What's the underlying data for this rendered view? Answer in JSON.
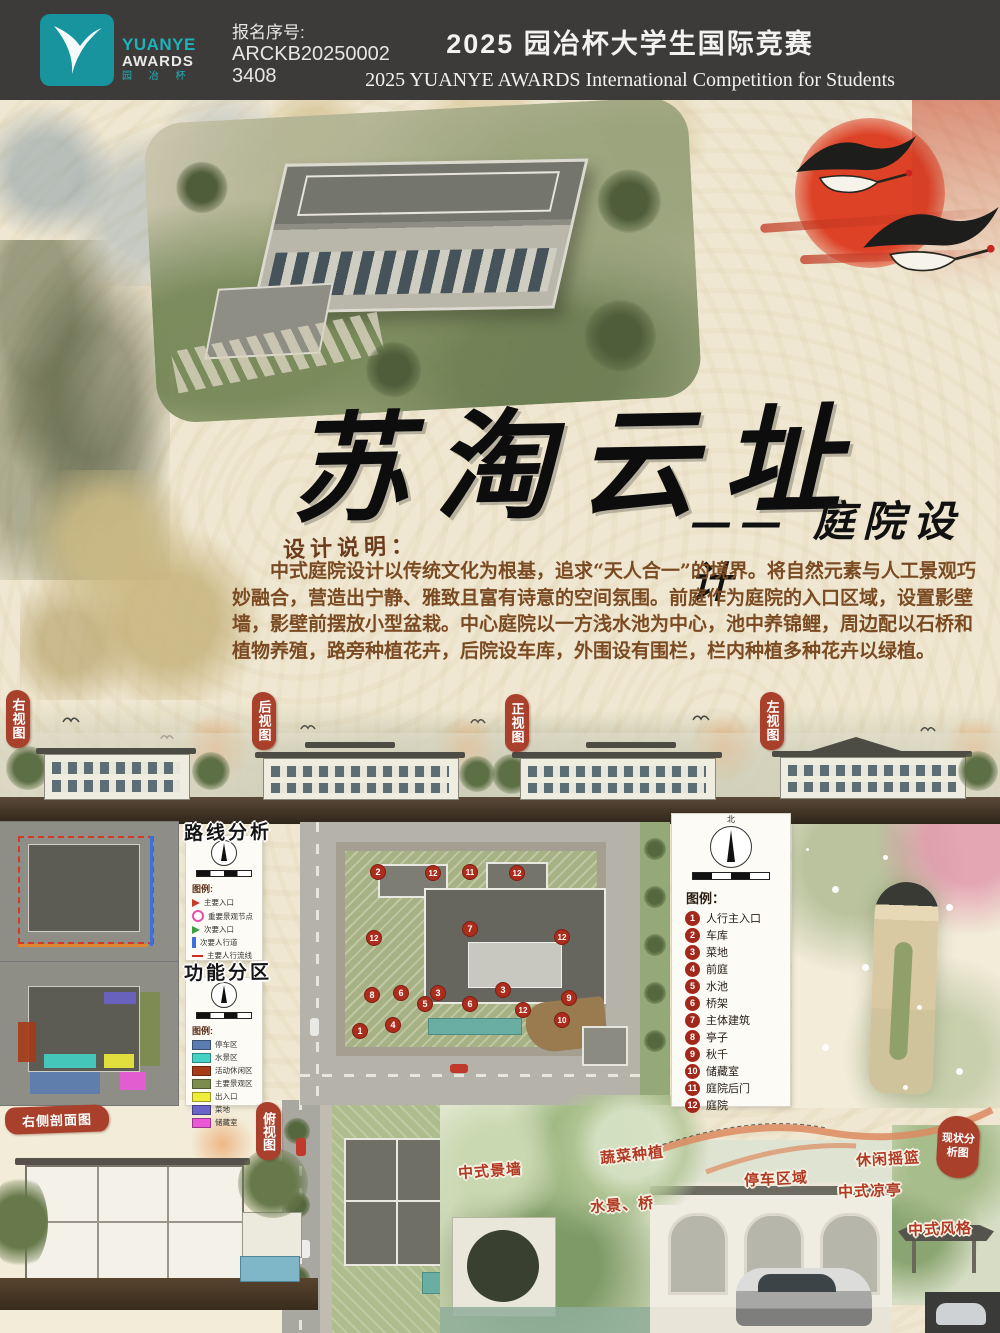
{
  "header": {
    "logo": {
      "yuanye": "YUANYE",
      "awards": "AWARDS",
      "cn": "园 冶 杯"
    },
    "reg_label": "报名序号:",
    "reg_line1": "ARCKB20250002",
    "reg_line2": "3408",
    "title_cn": "2025 园冶杯大学生国际竞赛",
    "title_en": "2025 YUANYE AWARDS International Competition for  Students"
  },
  "hero": {
    "title": "苏淘云址",
    "subtitle": "—— 庭院设计"
  },
  "description": {
    "label": "设计说明：",
    "text": "中式庭院设计以传统文化为根基，追求“天人合一”的境界。将自然元素与人工景观巧妙融合，营造出宁静、雅致且富有诗意的空间氛围。前庭作为庭院的入口区域，设置影壁墙，影壁前摆放小型盆栽。中心庭院以一方浅水池为中心，池中养锦鲤，周边配以石桥和植物养殖，路旁种植花卉，后院设车库，外围设有围栏，栏内种植多种花卉以绿植。"
  },
  "view_stamps": {
    "right": "右视图",
    "back": "后视图",
    "front": "正视图",
    "left": "左视图"
  },
  "route_analysis": {
    "title": "路线分析",
    "legend_label": "图例:",
    "items": [
      {
        "icon": "arrow",
        "label": "主要入口",
        "color": "#c53b2a"
      },
      {
        "icon": "circle",
        "label": "重要景观节点",
        "color": "#e54fae"
      },
      {
        "icon": "arrow",
        "label": "次要入口",
        "color": "#3d9e3f"
      },
      {
        "icon": "bar",
        "label": "次要人行道",
        "color": "#3f6fd8"
      },
      {
        "icon": "dash",
        "label": "主要人行流线",
        "color": "#cc2b1e"
      }
    ]
  },
  "function_zones": {
    "title": "功能分区",
    "legend_label": "图例:",
    "items": [
      {
        "label": "停车区",
        "color": "#5a7cb0"
      },
      {
        "label": "水景区",
        "color": "#43d2c5"
      },
      {
        "label": "活动休闲区",
        "color": "#a63b17"
      },
      {
        "label": "主要景观区",
        "color": "#7c8c4f"
      },
      {
        "label": "出入口",
        "color": "#f0ec3c"
      },
      {
        "label": "菜地",
        "color": "#6a63c8"
      },
      {
        "label": "储藏室",
        "color": "#ea58d8"
      }
    ]
  },
  "master_plan": {
    "stamp": "总平图",
    "north_label": "北",
    "legend_label": "图例：",
    "legend": [
      {
        "num": "1",
        "label": "人行主入口"
      },
      {
        "num": "2",
        "label": "车库"
      },
      {
        "num": "3",
        "label": "菜地"
      },
      {
        "num": "4",
        "label": "前庭"
      },
      {
        "num": "5",
        "label": "水池"
      },
      {
        "num": "6",
        "label": "桥架"
      },
      {
        "num": "7",
        "label": "主体建筑"
      },
      {
        "num": "8",
        "label": "亭子"
      },
      {
        "num": "9",
        "label": "秋千"
      },
      {
        "num": "10",
        "label": "储藏室"
      },
      {
        "num": "11",
        "label": "庭院后门"
      },
      {
        "num": "12",
        "label": "庭院"
      }
    ],
    "markers": [
      {
        "n": "2",
        "x": 77,
        "y": 49
      },
      {
        "n": "12",
        "x": 132,
        "y": 50
      },
      {
        "n": "11",
        "x": 169,
        "y": 49
      },
      {
        "n": "12",
        "x": 216,
        "y": 50
      },
      {
        "n": "12",
        "x": 73,
        "y": 115
      },
      {
        "n": "7",
        "x": 169,
        "y": 106
      },
      {
        "n": "12",
        "x": 261,
        "y": 114
      },
      {
        "n": "8",
        "x": 71,
        "y": 172
      },
      {
        "n": "6",
        "x": 100,
        "y": 170
      },
      {
        "n": "3",
        "x": 137,
        "y": 170
      },
      {
        "n": "3",
        "x": 202,
        "y": 167
      },
      {
        "n": "9",
        "x": 268,
        "y": 175
      },
      {
        "n": "5",
        "x": 124,
        "y": 181
      },
      {
        "n": "6",
        "x": 169,
        "y": 181
      },
      {
        "n": "12",
        "x": 222,
        "y": 187
      },
      {
        "n": "10",
        "x": 261,
        "y": 197
      },
      {
        "n": "4",
        "x": 92,
        "y": 202
      },
      {
        "n": "1",
        "x": 59,
        "y": 208
      }
    ]
  },
  "bottom": {
    "section_stamp": "右侧剖面图",
    "topview_stamp": "俯视图",
    "analysis_stamp": "现状分析图",
    "labels": [
      "中式景墙",
      "蔬菜种植",
      "水景、桥",
      "停车区域",
      "休闲摇篮",
      "中式凉亭",
      "中式风格"
    ]
  }
}
